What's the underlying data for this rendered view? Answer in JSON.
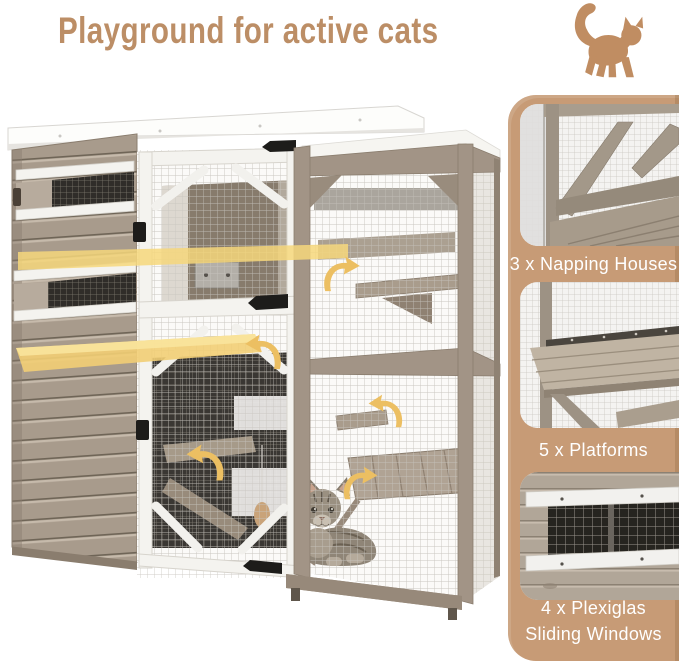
{
  "title": "Playground for active cats",
  "features": [
    {
      "label": "3 x Napping Houses"
    },
    {
      "label": "5 x Platforms"
    },
    {
      "label": "4 x Plexiglas Sliding Windows"
    }
  ],
  "icons": {
    "header_cat": "cat-silhouette",
    "motion_arrow": "curved-arrow"
  },
  "colors": {
    "title_text": "#BC8E66",
    "cat_icon": "#C08D62",
    "feature_panel_bg": "#C79B76",
    "feature_label_text": "#FFFFFF",
    "highlight_yellow": "#F2CE74",
    "arrow_yellow": "#ECBF62",
    "wood_frame": "#A29486",
    "white_trim": "#F6F5F1"
  }
}
